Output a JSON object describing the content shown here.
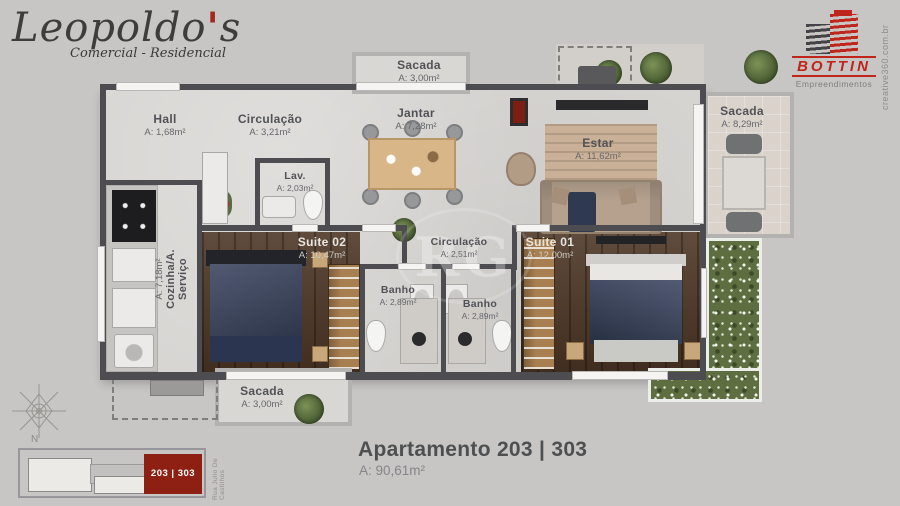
{
  "branding": {
    "leopoldos": {
      "name_main": "Leopoldo",
      "apostrophe": "'",
      "name_end": "s",
      "tagline": "Comercial - Residencial"
    },
    "bottin": {
      "name": "BOTTIN",
      "tagline": "Empreendimentos"
    },
    "credit": "creative360.com.br",
    "watermark": "RG"
  },
  "rooms": {
    "hall": {
      "label": "Hall",
      "area": "A: 1,68m²"
    },
    "circulacao_top": {
      "label": "Circulação",
      "area": "A: 3,21m²"
    },
    "sacada_top": {
      "label": "Sacada",
      "area": "A: 3,00m²"
    },
    "jantar": {
      "label": "Jantar",
      "area": "A: 7,28m²"
    },
    "estar": {
      "label": "Estar",
      "area": "A: 11,62m²"
    },
    "sacada_right": {
      "label": "Sacada",
      "area": "A: 8,29m²"
    },
    "lav": {
      "label": "Lav.",
      "area": "A: 2,03m²"
    },
    "cozinha": {
      "label": "Cozinha/A. Serviço",
      "area": "A: 7,18m²"
    },
    "suite02": {
      "label": "Suite 02",
      "area": "A: 10,47m²"
    },
    "circulacao_mid": {
      "label": "Circulação",
      "area": "A: 2,51m²"
    },
    "banho1": {
      "label": "Banho",
      "area": "A: 2,89m²"
    },
    "banho2": {
      "label": "Banho",
      "area": "A: 2,89m²"
    },
    "suite01": {
      "label": "Suite 01",
      "area": "A: 12,00m²"
    },
    "sacada_bottom": {
      "label": "Sacada",
      "area": "A: 3,00m²"
    }
  },
  "footer": {
    "title": "Apartamento 203 | 303",
    "area": "A: 90,61m²"
  },
  "site_plan": {
    "unit": "203 | 303",
    "street": "Rua Julio De Castilhos",
    "north": "N"
  },
  "icons": [
    "compass-rose-icon",
    "bottin-building-icon"
  ],
  "colors": {
    "accent_red": "#c0251b",
    "site_red": "#8e2013",
    "wall": "#4c4c51",
    "floor": "#d7d5d2",
    "wood": "#4e3726",
    "garden": "#5f6e41",
    "navy_bed": "#36415c"
  }
}
